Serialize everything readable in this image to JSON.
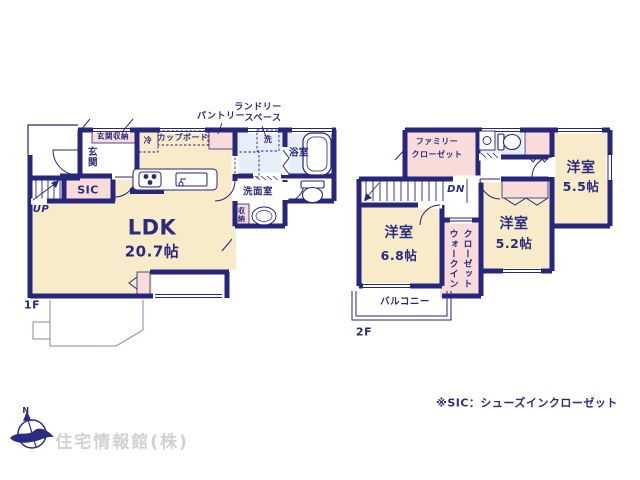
{
  "plan": {
    "floor1": {
      "label": "1F",
      "ldk": {
        "name": "LDK",
        "size": "20.7帖"
      },
      "genkan": "玄関",
      "genkan_storage": "玄関収納",
      "sic": "SIC",
      "up": "UP",
      "fridge": "冷",
      "cupboard": "カップボード",
      "pantry": "パントリー",
      "laundry_line1": "ランドリー",
      "laundry_line2": "スペース",
      "washer": "洗",
      "bath": "浴室",
      "washroom": "洗面室",
      "storage": "収納"
    },
    "floor2": {
      "label": "2F",
      "family_closet_line1": "ファミリー",
      "family_closet_line2": "クローゼット",
      "dn": "DN",
      "room68": {
        "name": "洋室",
        "size": "6.8帖"
      },
      "room52": {
        "name": "洋室",
        "size": "5.2帖"
      },
      "room55": {
        "name": "洋室",
        "size": "5.5帖"
      },
      "wic_line1": "ウォークイン",
      "wic_line2": "クローゼット",
      "balcony": "バルコニー"
    }
  },
  "footer": {
    "note": "※SIC：シューズインクローゼット",
    "company": "住宅情報館(株)",
    "compass_n": "N"
  },
  "colors": {
    "wall": "#26267c",
    "room_cream": "#f8ebca",
    "closet_pink": "#f9dbda",
    "wet_blue": "#e7eef7",
    "logo_gray": "#d2d2d2"
  }
}
